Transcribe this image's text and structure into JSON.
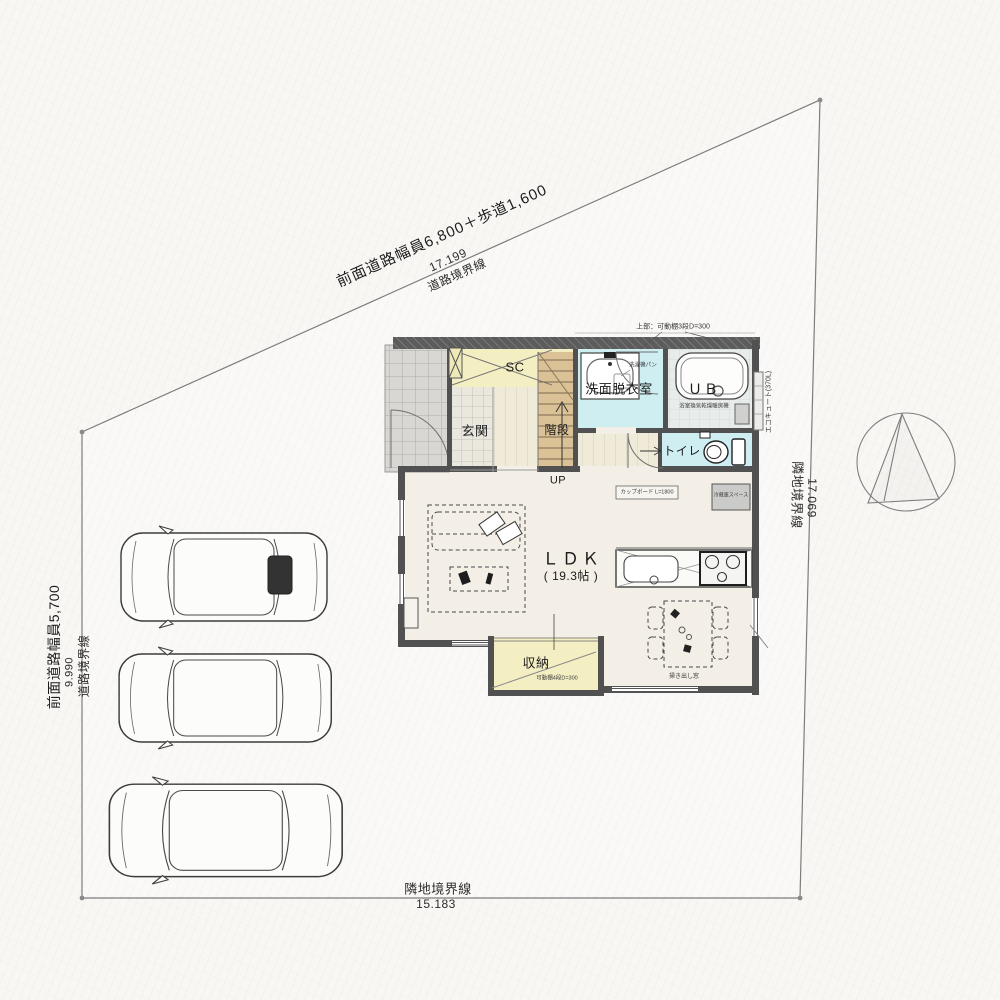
{
  "site": {
    "road_top": {
      "label": "前面道路幅員6,800＋歩道1,600",
      "length": "17.199",
      "line": "道路境界線"
    },
    "road_left": {
      "label": "前面道路幅員5,700",
      "length": "9.990",
      "line": "道路境界線"
    },
    "right": {
      "length": "17.069",
      "line": "隣地境界線"
    },
    "bottom": {
      "length": "15.183",
      "line": "隣地境界線"
    }
  },
  "rooms": {
    "ldk": {
      "name": "ＬＤＫ",
      "area": "( 19.3帖 )"
    },
    "genkan": "玄関",
    "stairs": "階段",
    "up": "UP",
    "sc": "SC",
    "washroom": "洗面脱衣室",
    "bath": "ＵＢ",
    "toilet": "トイレ",
    "storage": "収納"
  },
  "ann": {
    "upper_shelf": "上部：可動棚3段D=300",
    "washer_pan": "洗濯機パン",
    "bath_heater": "浴室換気乾燥暖房機",
    "water_heater": "エコキュート(370L)",
    "cupboard": "カップボード L=1800",
    "fridge": "冷蔵庫スペース",
    "storage_shelf": "可動棚4段D=300",
    "floor_window": "掃き出し窓"
  },
  "colors": {
    "paper": "#f8f7f4",
    "wall": "#515151",
    "water_room": "#cfeef1",
    "yellow_room": "#f4efc3",
    "wood_stairs": "#dbc196",
    "porch_tile": "#d8d7d3",
    "genkan_tile": "#eae7df",
    "ldk_floor": "#f3efe6",
    "line": "#7d7d7d"
  }
}
